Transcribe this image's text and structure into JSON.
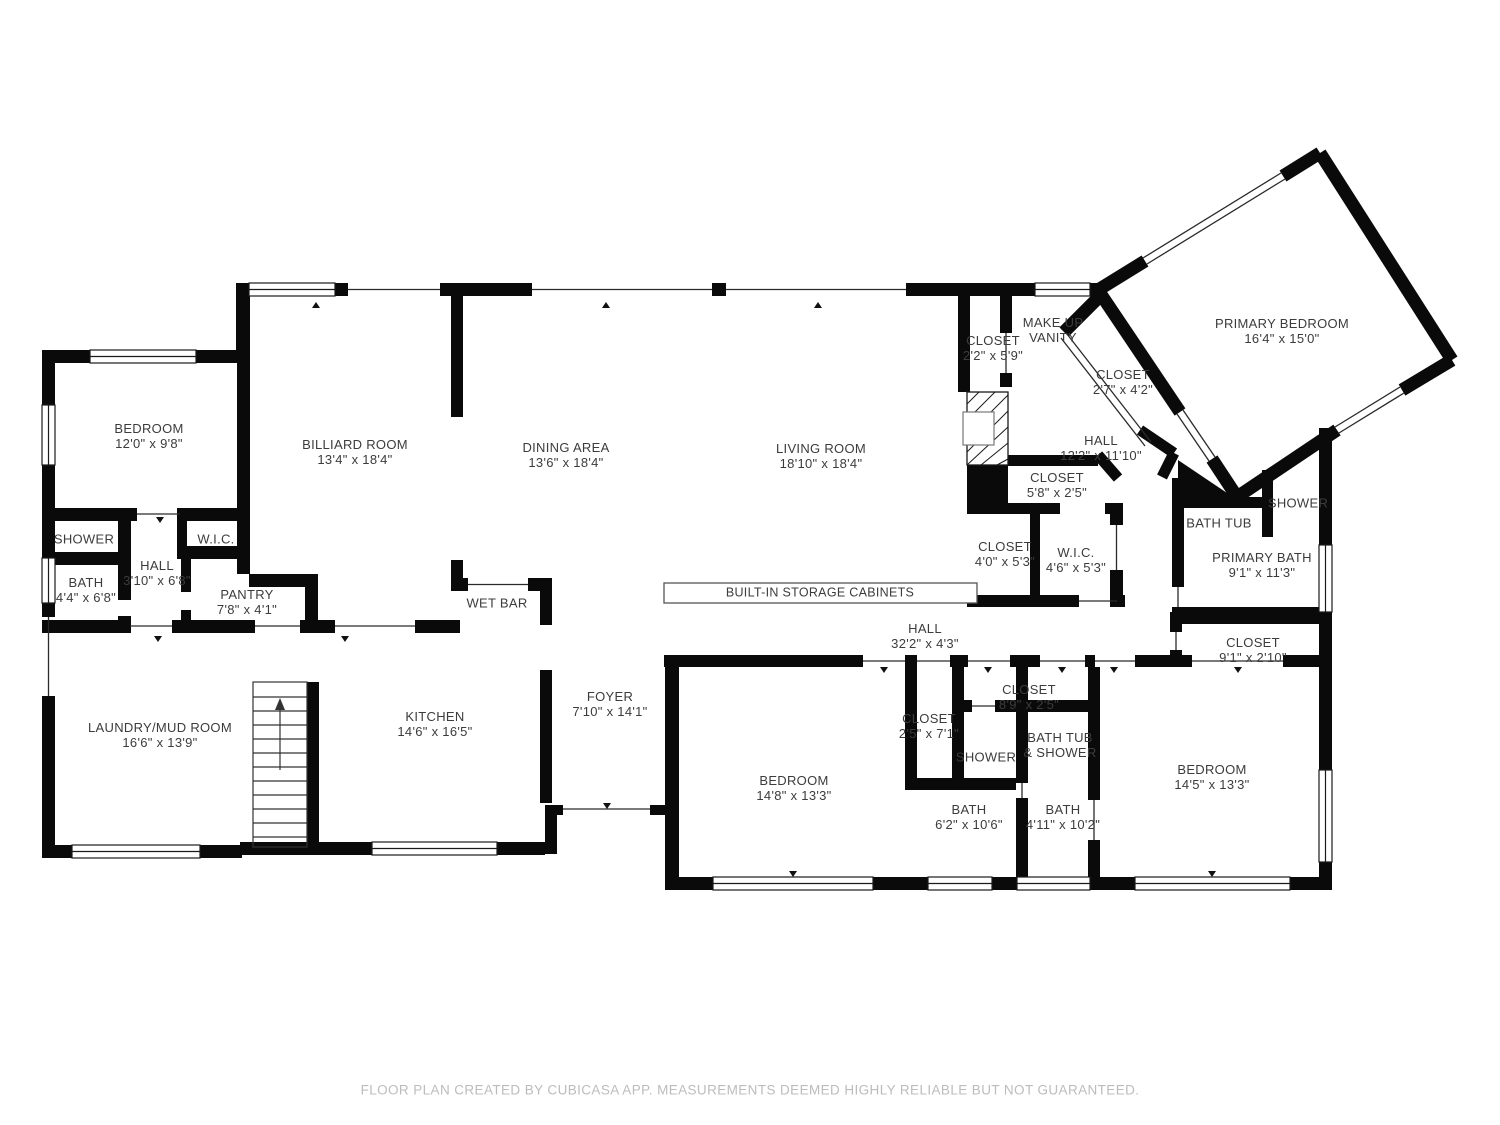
{
  "meta": {
    "app_footer": "FLOOR PLAN CREATED BY CUBICASA APP. MEASUREMENTS DEEMED HIGHLY RELIABLE BUT NOT GUARANTEED."
  },
  "colors": {
    "wall": "#0a0a0a",
    "label": "#3c3c3c",
    "footer": "#bcbcbc",
    "background": "#ffffff"
  },
  "rooms": [
    {
      "label": "BEDROOM",
      "dims": "12'0\" x 9'8\""
    },
    {
      "label": "BILLIARD ROOM",
      "dims": "13'4\" x 18'4\""
    },
    {
      "label": "DINING AREA",
      "dims": "13'6\" x 18'4\""
    },
    {
      "label": "LIVING ROOM",
      "dims": "18'10\" x 18'4\""
    },
    {
      "label": "MAKE UP",
      "dims": "VANITY"
    },
    {
      "label": "CLOSET",
      "dims": "2'2\" x 5'9\""
    },
    {
      "label": "CLOSET",
      "dims": "2'7\" x 4'2\""
    },
    {
      "label": "PRIMARY BEDROOM",
      "dims": "16'4\" x 15'0\""
    },
    {
      "label": "HALL",
      "dims": "12'2\" x 11'10\""
    },
    {
      "label": "CLOSET",
      "dims": "5'8\" x 2'5\""
    },
    {
      "label": "CLOSET",
      "dims": "4'0\" x 5'3\""
    },
    {
      "label": "W.I.C.",
      "dims": "4'6\" x 5'3\""
    },
    {
      "label": "SHOWER",
      "dims": ""
    },
    {
      "label": "BATH",
      "dims": "4'4\" x 6'8\""
    },
    {
      "label": "HALL",
      "dims": "3'10\" x 6'8\""
    },
    {
      "label": "W.I.C.",
      "dims": ""
    },
    {
      "label": "PANTRY",
      "dims": "7'8\" x 4'1\""
    },
    {
      "label": "WET BAR",
      "dims": ""
    },
    {
      "label": "BUILT-IN STORAGE CABINETS",
      "dims": ""
    },
    {
      "label": "HALL",
      "dims": "32'2\" x 4'3\""
    },
    {
      "label": "LAUNDRY/MUD ROOM",
      "dims": "16'6\" x 13'9\""
    },
    {
      "label": "KITCHEN",
      "dims": "14'6\" x 16'5\""
    },
    {
      "label": "FOYER",
      "dims": "7'10\" x 14'1\""
    },
    {
      "label": "BEDROOM",
      "dims": "14'8\" x 13'3\""
    },
    {
      "label": "CLOSET",
      "dims": "2'5\" x 7'1\""
    },
    {
      "label": "SHOWER",
      "dims": ""
    },
    {
      "label": "CLOSET",
      "dims": "8'9\" x 2'5\""
    },
    {
      "label": "BATH TUB",
      "dims": "& SHOWER"
    },
    {
      "label": "BATH",
      "dims": "6'2\" x 10'6\""
    },
    {
      "label": "BATH",
      "dims": "4'11\" x 10'2\""
    },
    {
      "label": "BEDROOM",
      "dims": "14'5\" x 13'3\""
    },
    {
      "label": "CLOSET",
      "dims": "9'1\" x 2'10\""
    },
    {
      "label": "BATH TUB",
      "dims": ""
    },
    {
      "label": "SHOWER",
      "dims": ""
    },
    {
      "label": "PRIMARY BATH",
      "dims": "9'1\" x 11'3\""
    }
  ]
}
